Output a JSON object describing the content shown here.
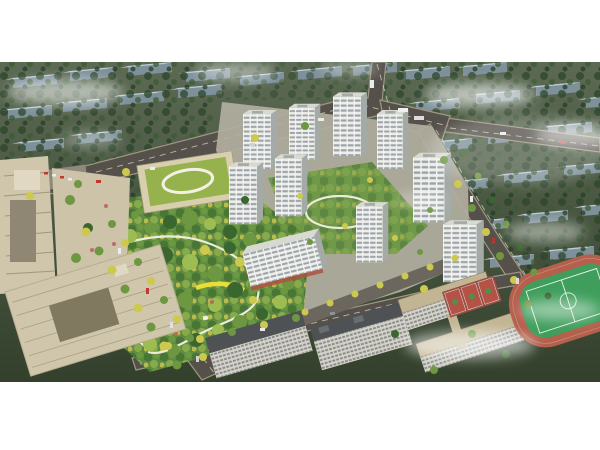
{
  "scene": {
    "type": "aerial-architectural-rendering",
    "regions": {
      "context_city": "context-city-blocks",
      "residential_towers": "white-residential-tower-cluster",
      "central_park": "central-landscape-park",
      "kindergarten": "green-roof-kindergarten",
      "office_left": "office-buildings-left",
      "school_campus": "school-campus",
      "sports_field": "running-track-sports-field",
      "roads": "arterial-roads-and-boulevard"
    }
  },
  "palette": {
    "haze": "#ffffff",
    "context_ground_top": "#5c6a54",
    "context_ground_bottom": "#33402c",
    "context_roof": "#bccdd5",
    "context_face": "#7e9099",
    "road": "#55514a",
    "road_line": "#ded8ca",
    "sidewalk": "#9e9783",
    "inner_street": "#6b675e",
    "site_ground": "#b2af9f",
    "tower_face": "#edeee9",
    "tower_side": "#a4aaa6",
    "tower_roof": "#d8dad2",
    "tower_win": "#8d959e",
    "win_small": "#6f7780",
    "park_green": "#5e8b44",
    "courtyard_green": "#70984d",
    "tree_dark": "#3a672f",
    "tree_mid": "#6d9741",
    "tree_light": "#9dbc52",
    "tree_yellow": "#ccc94e",
    "path": "#f3f0e4",
    "path_yellow": "#e8df36",
    "pond": "#bcd3d8",
    "office": "#cfc6ac",
    "office_dark": "#a1977d",
    "facade_light": "#d6d2c6",
    "dark_roof": "#4e5254",
    "school_roof": "#c2b593",
    "court_red": "#b55246",
    "field_green": "#3f9e5c",
    "track": "#b4604d",
    "awning_red": "#b05040",
    "car_red": "#c0392b",
    "car_white": "#ececec"
  }
}
